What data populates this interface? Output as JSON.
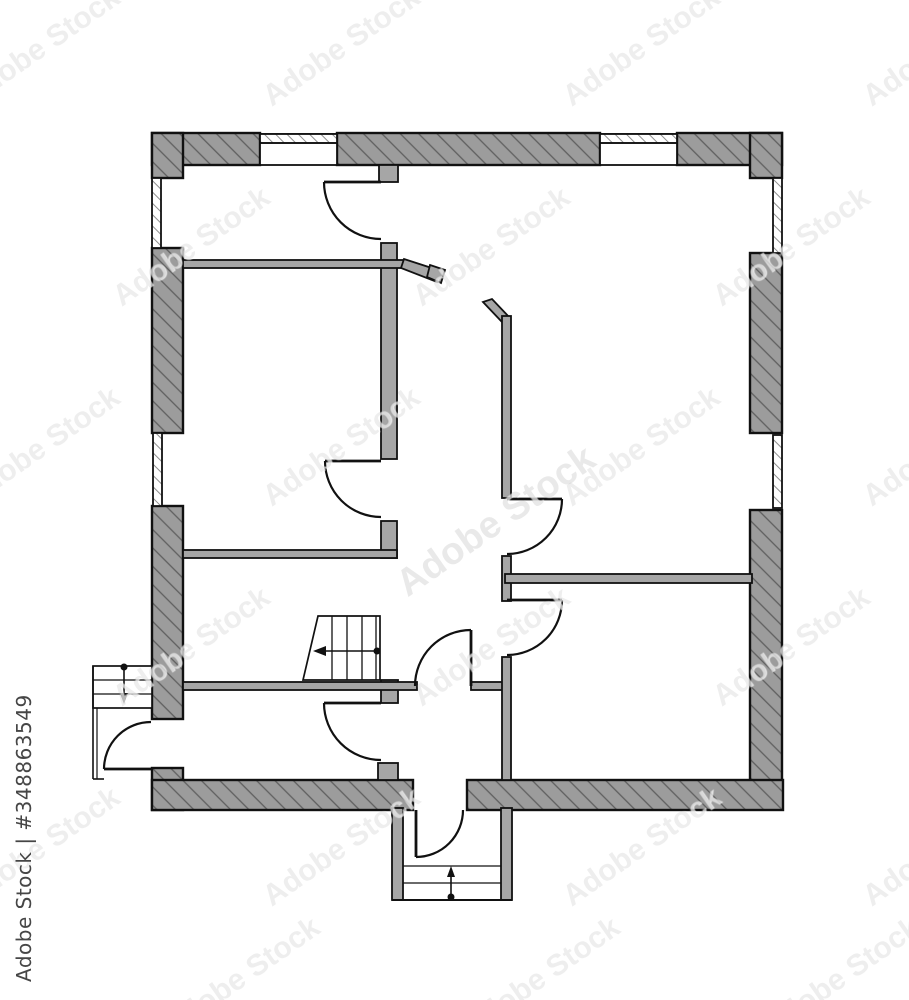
{
  "image": {
    "kind": "architectural 2D floor plan drawing, black and white",
    "background_color": "#ffffff"
  },
  "watermark": {
    "brand": "Adobe Stock",
    "stock_id": "#348863549",
    "vertical_label": "Adobe Stock | #348863549",
    "tile_text": "Adobe Stock",
    "tile_color": "#7d7d7d"
  },
  "plan": {
    "wall_fill": "#9c9c9c",
    "hatch_line_color": "#5f5f5f",
    "interior_wall_fill": "#a6a6a6",
    "outline_color": "#111111",
    "elements": {
      "door_count": 8,
      "window_count": 6,
      "staircase_count": 3
    },
    "icons": {
      "interior-stair-arrow": "left-arrow",
      "side-stair-arrow": "down-arrow",
      "entrance-stair-arrow": "up-arrow"
    }
  }
}
